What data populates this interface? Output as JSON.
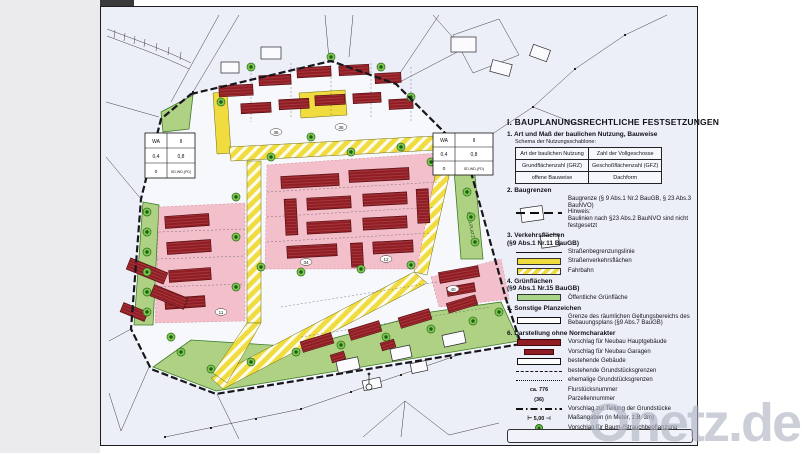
{
  "watermark": {
    "text": "Onetz.de"
  },
  "legend": {
    "title": "I. BAUPLANUNGSRECHTLICHE FESTSETZUNGEN",
    "sections": [
      {
        "heading": "1. Art und Maß der baulichen Nutzung, Bauweise",
        "sub": "Schema der Nutzungsschablone:",
        "table": [
          [
            "Art der baulichen Nutzung",
            "Zahl der Vollgeschosse"
          ],
          [
            "Grundflächenzahl (GRZ)",
            "Geschoßflächenzahl (GFZ)"
          ],
          [
            "offene Bauweise",
            "Dachform"
          ]
        ]
      },
      {
        "heading": "2. Baugrenzen",
        "items": [
          {
            "symbol": "baugrenze",
            "label": "Baugrenze (§ 9 Abs.1 Nr.2 BauGB, § 23 Abs.3 BauNVO)\nHinweis:\nBaulinien nach §23 Abs.2 BauNVO sind nicht festgesetzt"
          }
        ]
      },
      {
        "heading": "3. Verkehrsflächen\n(§9 Abs.1 Nr.11 BauGB)",
        "items": [
          {
            "symbol": "thinline",
            "label": "Straßenbegrenzungslinie"
          },
          {
            "symbol": "yellow",
            "label": "Straßenverkehrsflächen"
          },
          {
            "symbol": "striped",
            "label": "Fahrbahn"
          }
        ]
      },
      {
        "heading": "4. Grünflächen\n(§9 Abs.1 Nr.15 BauGB)",
        "items": [
          {
            "symbol": "green",
            "label": "Öffentliche Grünfläche"
          }
        ]
      },
      {
        "heading": "5. Sonstige Planzeichen",
        "items": [
          {
            "symbol": "whitebox",
            "label": "Grenze des räumlichen Geltungsbereichs des Bebauungsplans (§9 Abs.7 BauGB)"
          }
        ]
      },
      {
        "heading": "6. Darstellung ohne Normcharakter",
        "items": [
          {
            "symbol": "redbox",
            "label": "Vorschlag für Neubau Hauptgebäude"
          },
          {
            "symbol": "redbox-sm",
            "label": "Vorschlag für Neubau Garagen"
          },
          {
            "symbol": "whitebox",
            "label": "bestehende Gebäude"
          },
          {
            "symbol": "dashed",
            "label": "bestehende Grundstücksgrenzen"
          },
          {
            "symbol": "dotted",
            "label": "ehemalige Grundstücksgrenzen"
          },
          {
            "symbol": "flur",
            "symbol_text": "ca. 776",
            "label": "Flurstücksnummer"
          },
          {
            "symbol": "parz",
            "symbol_text": "(36)",
            "label": "Parzellennummer"
          },
          {
            "symbol": "dashdot",
            "label": "Vorschlag zur Teilung der Grundstücke"
          },
          {
            "symbol": "measure",
            "symbol_text": "⊢ 5,00 ⊣",
            "label": "Maßangaben (in Meter, z.B. 3m)"
          },
          {
            "symbol": "tree",
            "label": "Vorschlag für Baum-/Strauchbepflanzung"
          },
          {
            "symbol": "triangle",
            "label": "Vorgeschlagene Grundstückszufahrt"
          }
        ]
      }
    ]
  },
  "map": {
    "schablone": {
      "r0c0": "WA",
      "r0c1": "II",
      "r1c0": "0,4",
      "r1c1": "0,8",
      "r2c0": "o",
      "r2c1": "SD,WD,(FD)"
    },
    "green_label": "SPIELPLATZ",
    "parcel_numbers": [
      "36",
      "35",
      "34",
      "12",
      "11",
      "40"
    ],
    "colors": {
      "road_yellow": "#f0dc3e",
      "plot_pink": "#f2bfca",
      "building_red": "#8f1d23",
      "public_green": "#aed183",
      "paper": "#edeff8"
    }
  }
}
